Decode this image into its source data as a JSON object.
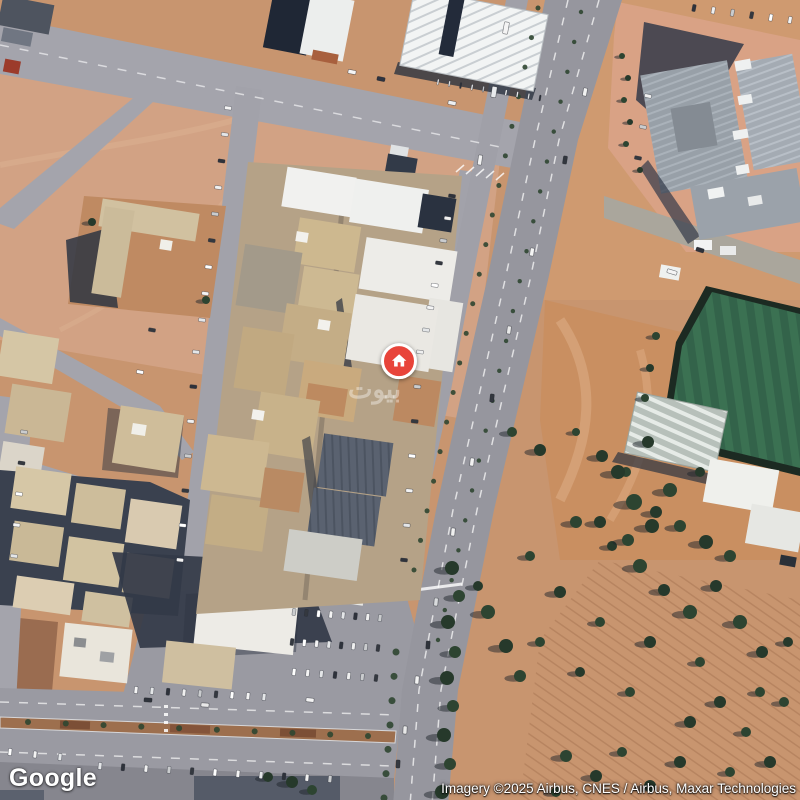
{
  "window": {
    "width": 800,
    "height": 800,
    "view_type": "satellite-map"
  },
  "map": {
    "view": "satellite",
    "logo_text": "Google",
    "attribution_text": "Imagery ©2025 Airbus, CNES / Airbus, Maxar Technologies",
    "watermark_text": "بيوت",
    "marker": {
      "kind": "property-home-pin",
      "color": "#E8443A",
      "ring_color": "#FFFFFF",
      "icon": "home-icon",
      "x": 399,
      "y": 362
    }
  },
  "palette": {
    "sand": "#c8956f",
    "sand_light": "#d2a284",
    "sand_salmon": "#d9a285",
    "road_grey": "#9a9aa2",
    "highway_grey": "#96969e",
    "shadow_navy": "#2c3340",
    "field_green": "#33634a",
    "tree_green": "#2d4431",
    "roof_white": "#efefec",
    "roof_beige": "#cdb891",
    "roof_navy": "#1f2735",
    "dirt_median": "#9d6f4e"
  },
  "map_features": {
    "car_colors": [
      "#f4f4f4",
      "#e4e6e8",
      "#2e323b",
      "#f0f0f0",
      "#caccce",
      "#34383f",
      "#ffffff"
    ],
    "trees": [
      [
        452,
        568,
        7
      ],
      [
        459,
        596,
        6
      ],
      [
        448,
        622,
        7
      ],
      [
        455,
        652,
        6
      ],
      [
        447,
        678,
        7
      ],
      [
        453,
        706,
        6
      ],
      [
        444,
        735,
        7
      ],
      [
        450,
        764,
        6
      ],
      [
        442,
        792,
        7
      ],
      [
        512,
        432,
        5
      ],
      [
        540,
        450,
        6
      ],
      [
        576,
        432,
        4
      ],
      [
        602,
        456,
        6
      ],
      [
        626,
        472,
        5
      ],
      [
        648,
        442,
        6
      ],
      [
        670,
        490,
        7
      ],
      [
        700,
        472,
        5
      ],
      [
        576,
        522,
        6
      ],
      [
        612,
        546,
        5
      ],
      [
        640,
        566,
        7
      ],
      [
        664,
        590,
        6
      ],
      [
        690,
        612,
        7
      ],
      [
        716,
        586,
        6
      ],
      [
        740,
        622,
        7
      ],
      [
        762,
        652,
        6
      ],
      [
        700,
        662,
        5
      ],
      [
        650,
        642,
        6
      ],
      [
        600,
        622,
        5
      ],
      [
        560,
        592,
        6
      ],
      [
        530,
        556,
        5
      ],
      [
        720,
        702,
        6
      ],
      [
        746,
        732,
        5
      ],
      [
        690,
        722,
        6
      ],
      [
        630,
        692,
        5
      ],
      [
        580,
        672,
        5
      ],
      [
        540,
        642,
        5
      ],
      [
        770,
        762,
        6
      ],
      [
        730,
        772,
        5
      ],
      [
        680,
        762,
        6
      ],
      [
        760,
        692,
        5
      ],
      [
        788,
        642,
        5
      ],
      [
        784,
        702,
        5
      ],
      [
        656,
        512,
        6
      ],
      [
        680,
        526,
        6
      ],
      [
        706,
        542,
        7
      ],
      [
        730,
        556,
        6
      ],
      [
        618,
        472,
        7
      ],
      [
        634,
        502,
        8
      ],
      [
        652,
        526,
        7
      ],
      [
        628,
        540,
        6
      ],
      [
        600,
        522,
        6
      ],
      [
        488,
        612,
        7
      ],
      [
        506,
        646,
        7
      ],
      [
        520,
        676,
        6
      ],
      [
        478,
        586,
        5
      ],
      [
        566,
        756,
        6
      ],
      [
        596,
        776,
        6
      ],
      [
        622,
        752,
        5
      ],
      [
        650,
        786,
        6
      ],
      [
        556,
        792,
        5
      ],
      [
        292,
        782,
        6
      ],
      [
        312,
        790,
        5
      ],
      [
        268,
        777,
        5
      ],
      [
        622,
        56,
        3
      ],
      [
        628,
        78,
        3
      ],
      [
        624,
        100,
        3
      ],
      [
        630,
        122,
        3
      ],
      [
        626,
        144,
        3
      ],
      [
        640,
        170,
        3
      ],
      [
        656,
        336,
        4
      ],
      [
        650,
        368,
        4
      ],
      [
        645,
        398,
        4
      ],
      [
        92,
        222,
        4
      ],
      [
        206,
        300,
        4
      ]
    ],
    "bush_lines": [
      {
        "x1": 538,
        "y1": 8,
        "x2": 414,
        "y2": 570,
        "n": 20,
        "r": 2.5
      },
      {
        "x1": 581,
        "y1": 12,
        "x2": 438,
        "y2": 640,
        "n": 22,
        "r": 2.2
      },
      {
        "x1": 396,
        "y1": 652,
        "x2": 384,
        "y2": 798,
        "n": 7,
        "r": 3.5
      },
      {
        "x1": 28,
        "y1": 722,
        "x2": 368,
        "y2": 736,
        "n": 10,
        "r": 3
      }
    ],
    "car_rows": [
      {
        "x1": 228,
        "y1": 108,
        "x2": 202,
        "y2": 320,
        "n": 9,
        "rot": 8,
        "w": 7,
        "h": 3.5
      },
      {
        "x1": 196,
        "y1": 352,
        "x2": 180,
        "y2": 560,
        "n": 7,
        "rot": 6,
        "w": 7,
        "h": 3.5
      },
      {
        "x1": 452,
        "y1": 196,
        "x2": 426,
        "y2": 330,
        "n": 7,
        "rot": 8,
        "w": 7,
        "h": 3.5
      },
      {
        "x1": 420,
        "y1": 352,
        "x2": 404,
        "y2": 560,
        "n": 7,
        "rot": 6,
        "w": 7,
        "h": 3.5
      },
      {
        "x1": 294,
        "y1": 612,
        "x2": 380,
        "y2": 618,
        "n": 8,
        "rot": 97,
        "w": 7,
        "h": 3.5
      },
      {
        "x1": 292,
        "y1": 642,
        "x2": 378,
        "y2": 648,
        "n": 8,
        "rot": 97,
        "w": 7,
        "h": 3.5
      },
      {
        "x1": 294,
        "y1": 672,
        "x2": 376,
        "y2": 678,
        "n": 7,
        "rot": 97,
        "w": 7,
        "h": 3.5
      },
      {
        "x1": 136,
        "y1": 690,
        "x2": 264,
        "y2": 697,
        "n": 9,
        "rot": 96,
        "w": 7,
        "h": 3.5
      },
      {
        "x1": 100,
        "y1": 766,
        "x2": 330,
        "y2": 779,
        "n": 11,
        "rot": 96,
        "w": 7,
        "h": 3.5
      },
      {
        "x1": 694,
        "y1": 8,
        "x2": 790,
        "y2": 20,
        "n": 6,
        "rot": 101,
        "w": 7,
        "h": 3.5
      },
      {
        "x1": 648,
        "y1": 96,
        "x2": 638,
        "y2": 158,
        "n": 3,
        "rot": 12,
        "w": 7,
        "h": 3.5
      },
      {
        "x1": 24,
        "y1": 432,
        "x2": 14,
        "y2": 556,
        "n": 5,
        "rot": 8,
        "w": 7,
        "h": 3.5
      },
      {
        "x1": 152,
        "y1": 330,
        "x2": 140,
        "y2": 372,
        "n": 2,
        "rot": 10,
        "w": 7,
        "h": 3.5
      },
      {
        "x1": 10,
        "y1": 752,
        "x2": 60,
        "y2": 757,
        "n": 3,
        "rot": 96,
        "w": 7,
        "h": 3.5
      },
      {
        "x1": 438,
        "y1": 82,
        "x2": 540,
        "y2": 98,
        "n": 10,
        "rot": 100,
        "w": 6,
        "h": 1.6
      }
    ],
    "cars": [
      [
        352,
        72,
        11,
        "#f5f5f5"
      ],
      [
        381,
        79,
        11,
        "#2e3340"
      ],
      [
        452,
        103,
        11,
        "#eef0f2"
      ],
      [
        585,
        92,
        100,
        "#f2f2f2"
      ],
      [
        565,
        160,
        99,
        "#32363e"
      ],
      [
        532,
        252,
        98,
        "#f4f4f4"
      ],
      [
        509,
        330,
        97,
        "#e8e8e8"
      ],
      [
        492,
        398,
        96,
        "#33373f"
      ],
      [
        472,
        462,
        96,
        "#f2f2f2"
      ],
      [
        453,
        532,
        95,
        "#f0f0f0"
      ],
      [
        436,
        602,
        95,
        "#d9dbdd"
      ],
      [
        428,
        645,
        94,
        "#2f333b"
      ],
      [
        417,
        680,
        94,
        "#f2f2f2"
      ],
      [
        405,
        730,
        93,
        "#e8e8e8"
      ],
      [
        398,
        764,
        93,
        "#34383f"
      ],
      [
        310,
        700,
        5,
        "#f4f4f4"
      ],
      [
        205,
        705,
        4,
        "#e9e9e9"
      ],
      [
        148,
        700,
        4,
        "#2f333b"
      ],
      [
        506,
        28,
        100,
        "#f4f4f4",
        12,
        5
      ],
      [
        494,
        92,
        99,
        "#e8eaec",
        11,
        5
      ],
      [
        480,
        160,
        98,
        "#f2f2f2",
        10,
        4
      ],
      [
        672,
        272,
        17,
        "#f4f4f4",
        10,
        4
      ],
      [
        700,
        250,
        17,
        "#2e323a",
        8,
        4
      ]
    ]
  }
}
